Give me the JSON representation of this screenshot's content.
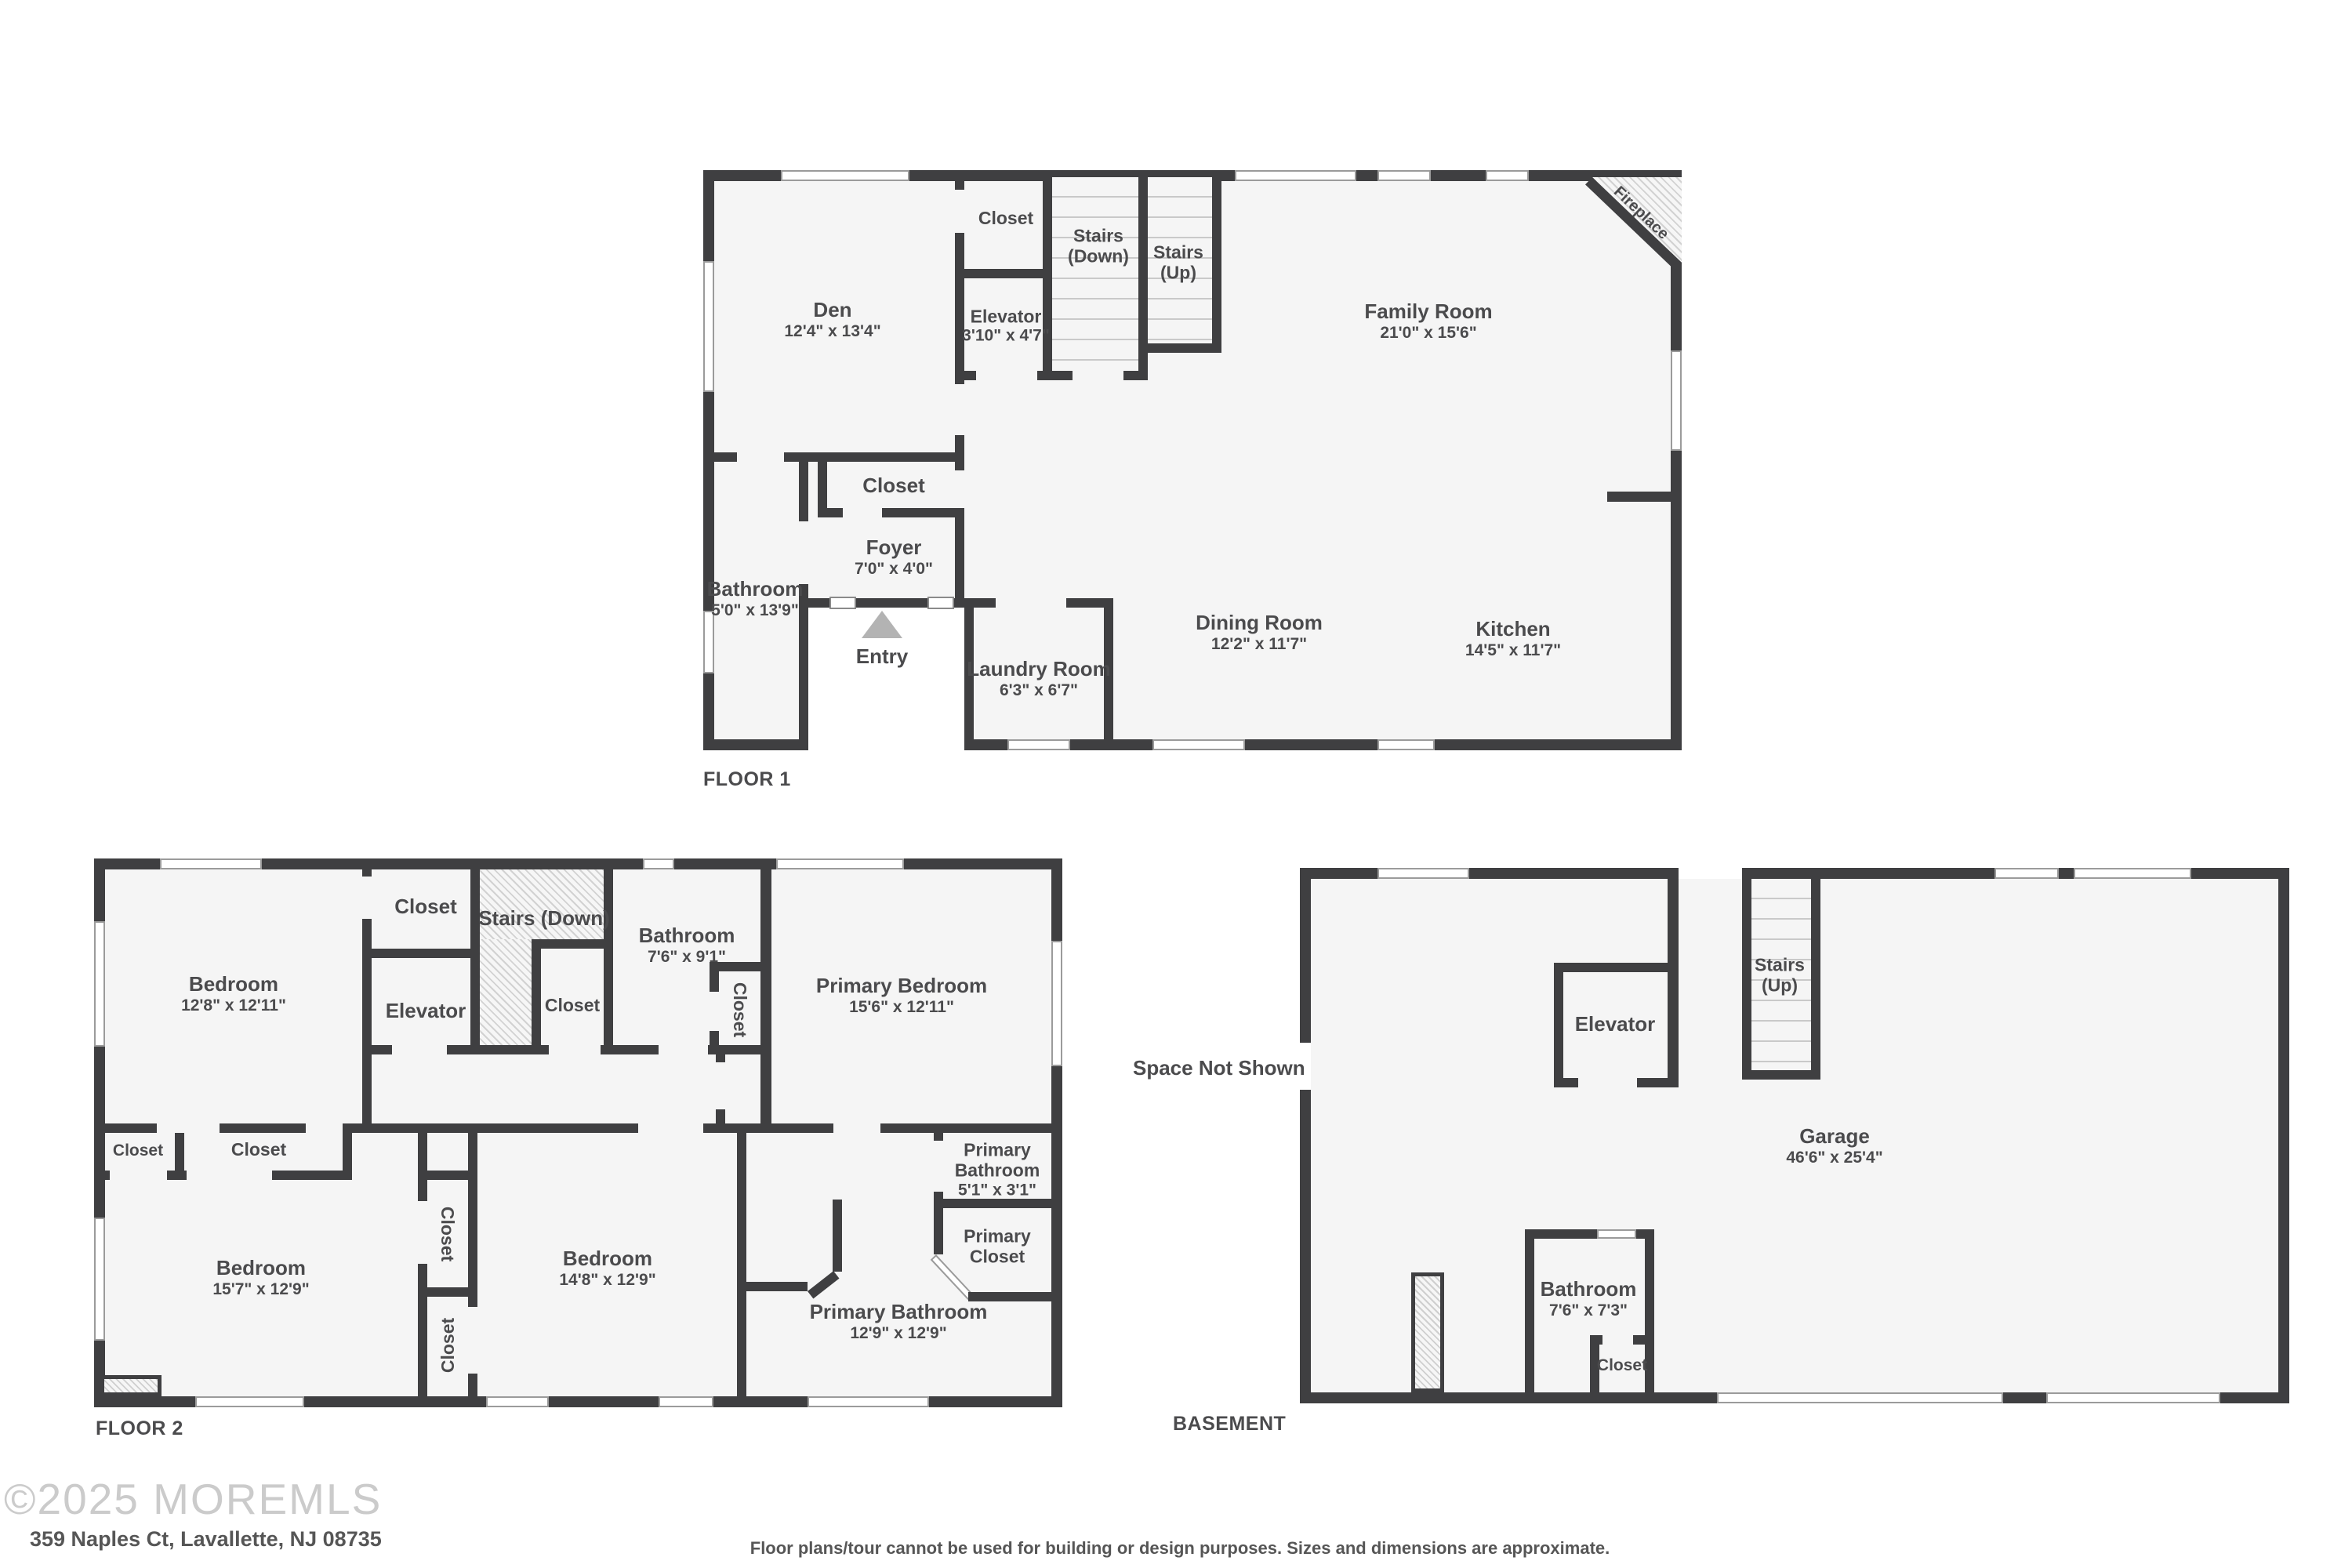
{
  "footer": {
    "copyright": "©2025 MOREMLS",
    "address": "359 Naples Ct, Lavallette, NJ 08735",
    "disclaimer": "Floor plans/tour cannot be used for building or design purposes. Sizes and dimensions are approximate."
  },
  "colors": {
    "wall": "#3f3f41",
    "floor": "#f5f5f5",
    "label": "#4b4b4d",
    "entry_arrow": "#b3b3b3"
  },
  "floor1": {
    "title": "FLOOR 1",
    "den": {
      "name": "Den",
      "dims": "12'4\" x 13'4\""
    },
    "closet_top": {
      "name": "Closet"
    },
    "stairs_down": {
      "line1": "Stairs",
      "line2": "(Down)"
    },
    "stairs_up": {
      "line1": "Stairs",
      "line2": "(Up)"
    },
    "elevator": {
      "name": "Elevator",
      "dims": "3'10\" x 4'7\""
    },
    "family_room": {
      "name": "Family Room",
      "dims": "21'0\" x 15'6\""
    },
    "fireplace": {
      "name": "Fireplace"
    },
    "closet_mid": {
      "name": "Closet"
    },
    "foyer": {
      "name": "Foyer",
      "dims": "7'0\" x 4'0\""
    },
    "bathroom": {
      "name": "Bathroom",
      "dims": "5'0\" x 13'9\""
    },
    "entry": {
      "name": "Entry"
    },
    "laundry": {
      "name": "Laundry Room",
      "dims": "6'3\" x 6'7\""
    },
    "dining": {
      "name": "Dining Room",
      "dims": "12'2\" x 11'7\""
    },
    "kitchen": {
      "name": "Kitchen",
      "dims": "14'5\" x 11'7\""
    }
  },
  "floor2": {
    "title": "FLOOR 2",
    "bedroom1": {
      "name": "Bedroom",
      "dims": "12'8\" x 12'11\""
    },
    "closet_top": {
      "name": "Closet"
    },
    "elevator": {
      "name": "Elevator"
    },
    "stairs_down": {
      "name": "Stairs (Down)"
    },
    "closet_nook": {
      "name": "Closet"
    },
    "bathroom": {
      "name": "Bathroom",
      "dims": "7'6\" x 9'1\""
    },
    "closet_bath": {
      "name": "Closet"
    },
    "primary_bedroom": {
      "name": "Primary Bedroom",
      "dims": "15'6\" x 12'11\""
    },
    "closet_small": {
      "name": "Closet"
    },
    "closet_wide": {
      "name": "Closet"
    },
    "bedroom2": {
      "name": "Bedroom",
      "dims": "15'7\" x 12'9\""
    },
    "closet_col1": {
      "name": "Closet"
    },
    "closet_col2": {
      "name": "Closet"
    },
    "bedroom3": {
      "name": "Bedroom",
      "dims": "14'8\" x 12'9\""
    },
    "primary_bathroom": {
      "name": "Primary Bathroom",
      "dims": "12'9\" x 12'9\""
    },
    "primary_bathroom_small": {
      "line1": "Primary",
      "line2": "Bathroom",
      "dims": "5'1\" x 3'1\""
    },
    "primary_closet": {
      "line1": "Primary",
      "line2": "Closet"
    }
  },
  "basement": {
    "title": "BASEMENT",
    "space_not_shown": {
      "name": "Space Not Shown"
    },
    "elevator": {
      "name": "Elevator"
    },
    "stairs_up": {
      "line1": "Stairs",
      "line2": "(Up)"
    },
    "garage": {
      "name": "Garage",
      "dims": "46'6\" x 25'4\""
    },
    "bathroom": {
      "name": "Bathroom",
      "dims": "7'6\" x 7'3\""
    },
    "closet": {
      "name": "Closet"
    }
  }
}
